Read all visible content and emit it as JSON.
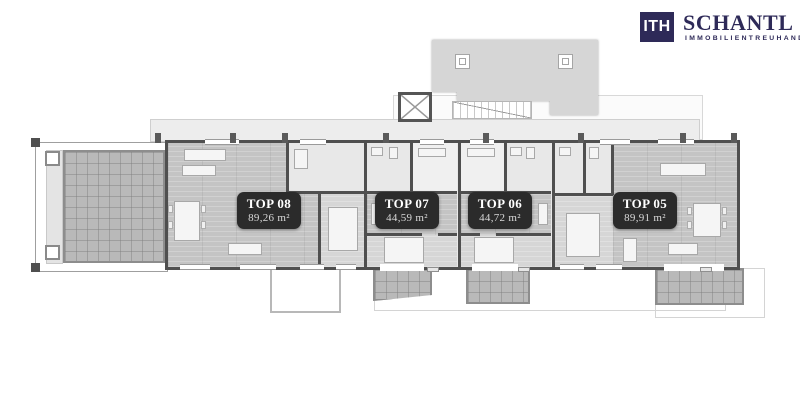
{
  "logo": {
    "monogram": "ITH",
    "brand": "SCHANTL",
    "subtitle": "IMMOBILIENTREUHAND",
    "brand_color": "#2e2a58"
  },
  "apartments": [
    {
      "id": "top-08",
      "label": "TOP 08",
      "area": "89,26 m²"
    },
    {
      "id": "top-07",
      "label": "TOP 07",
      "area": "44,59 m²"
    },
    {
      "id": "top-06",
      "label": "TOP 06",
      "area": "44,72 m²"
    },
    {
      "id": "top-05",
      "label": "TOP 05",
      "area": "89,91 m²"
    }
  ],
  "colors": {
    "badge_bg": "#2b2b2b",
    "wall": "#4f4f4f",
    "terrace_fill": "#b9b9b9",
    "roof_fill": "#d6d6d6",
    "living_floor": "#c4c4c4"
  },
  "icons": [
    "elevator-icon",
    "staircase-icon",
    "skylight-icon"
  ]
}
